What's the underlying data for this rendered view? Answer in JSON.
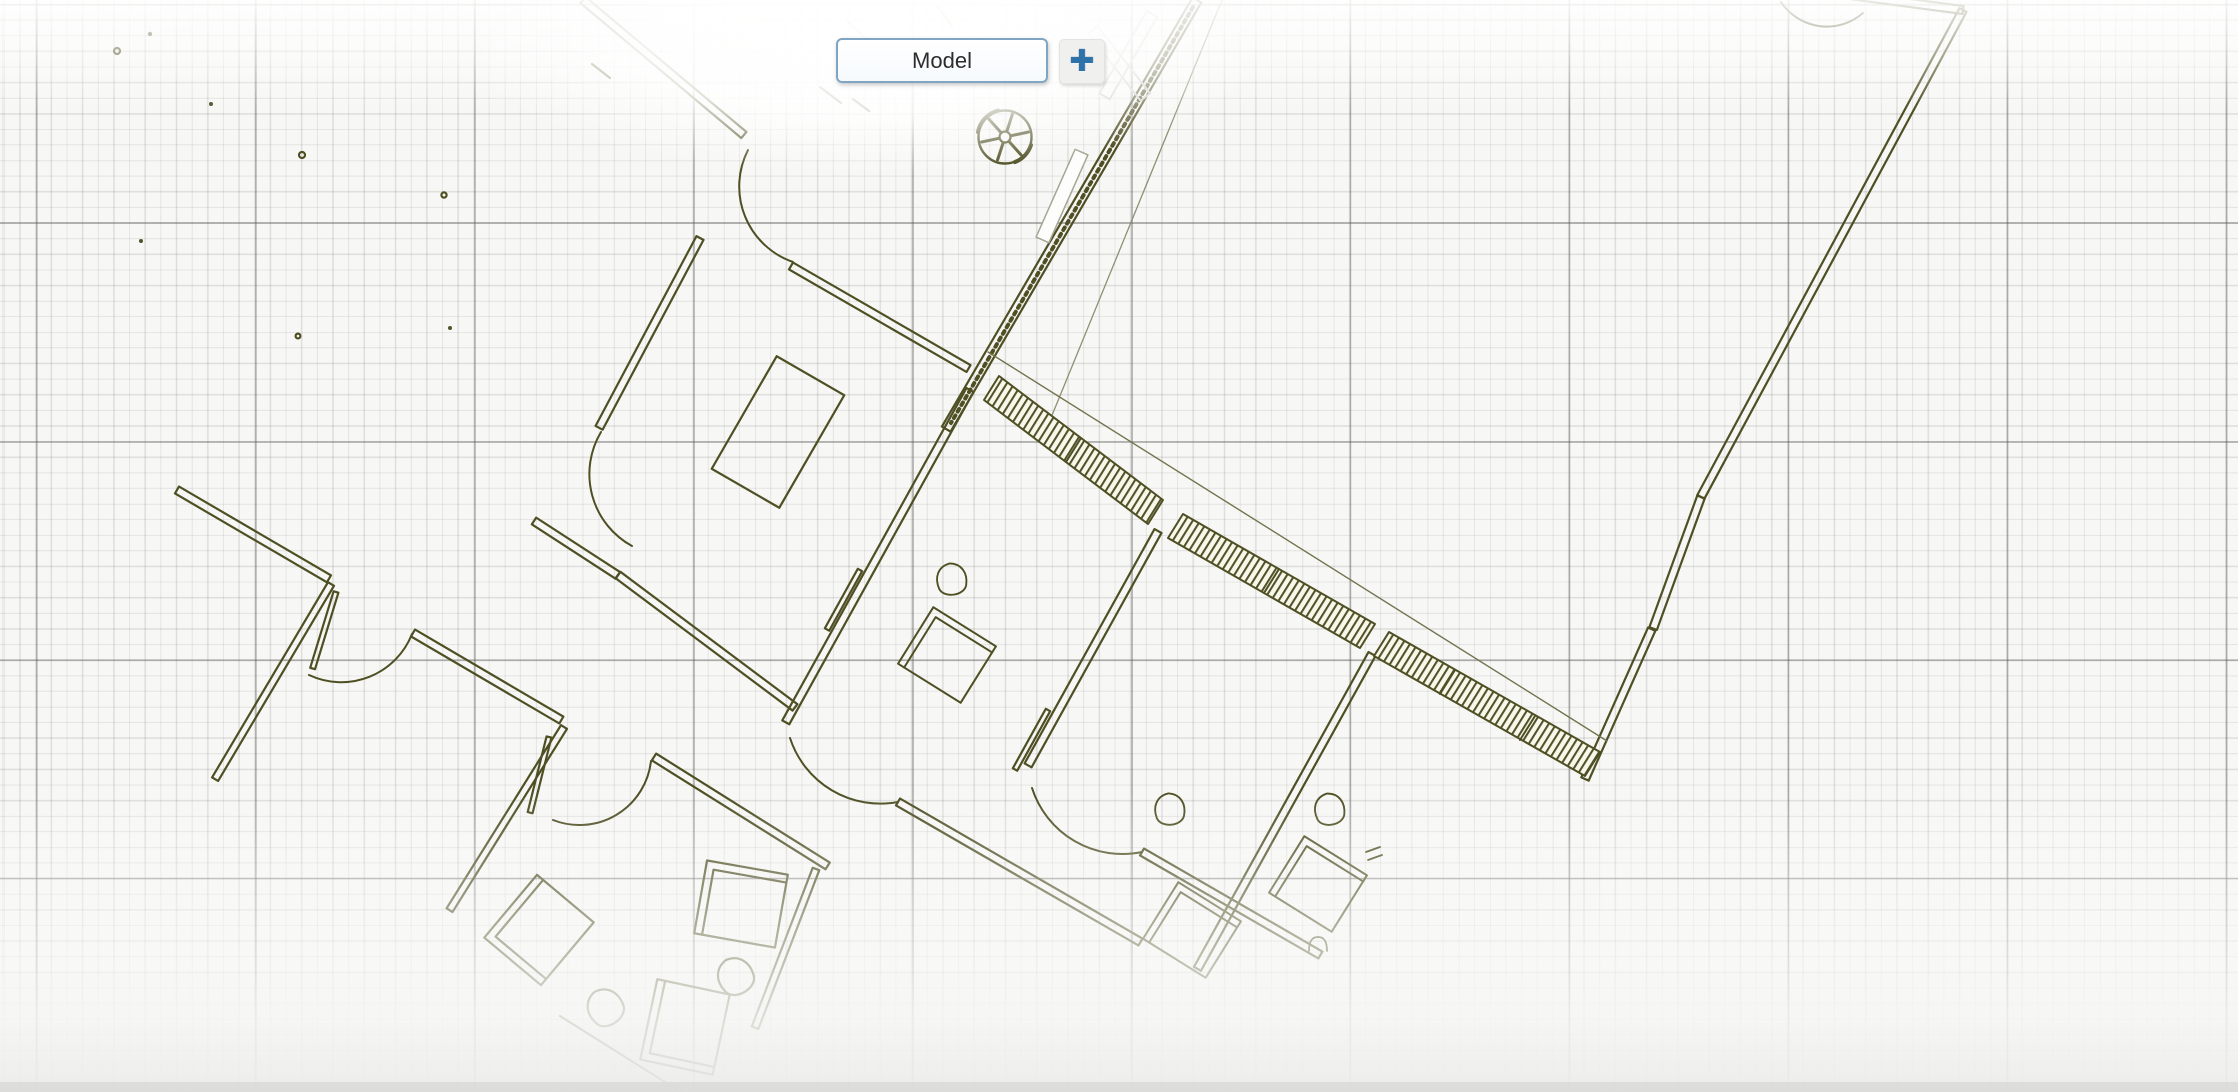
{
  "app": {
    "description": "CAD model space canvas showing a rotated architectural floor plan on a drawing grid"
  },
  "layout_tabs": {
    "model_tab": {
      "label": "Model",
      "active": true
    },
    "add_button": {
      "icon": "plus-icon",
      "glyph": "✚",
      "action": "add layout"
    }
  },
  "canvas": {
    "drawing_type": "architectural floor plan",
    "visible_features": [
      "walls",
      "door swing arcs",
      "hatched wall bands",
      "desks",
      "chairs",
      "meeting table",
      "ceiling-fan symbol",
      "drawing grid"
    ],
    "colors": {
      "background": "#f7f7f5",
      "grid_minor": "#dddddb",
      "grid_major": "#8e8e8c",
      "linework_olive": "#4f4f24",
      "tab_border_blue": "#7fa5c2",
      "plus_blue": "#2d72a8"
    }
  }
}
